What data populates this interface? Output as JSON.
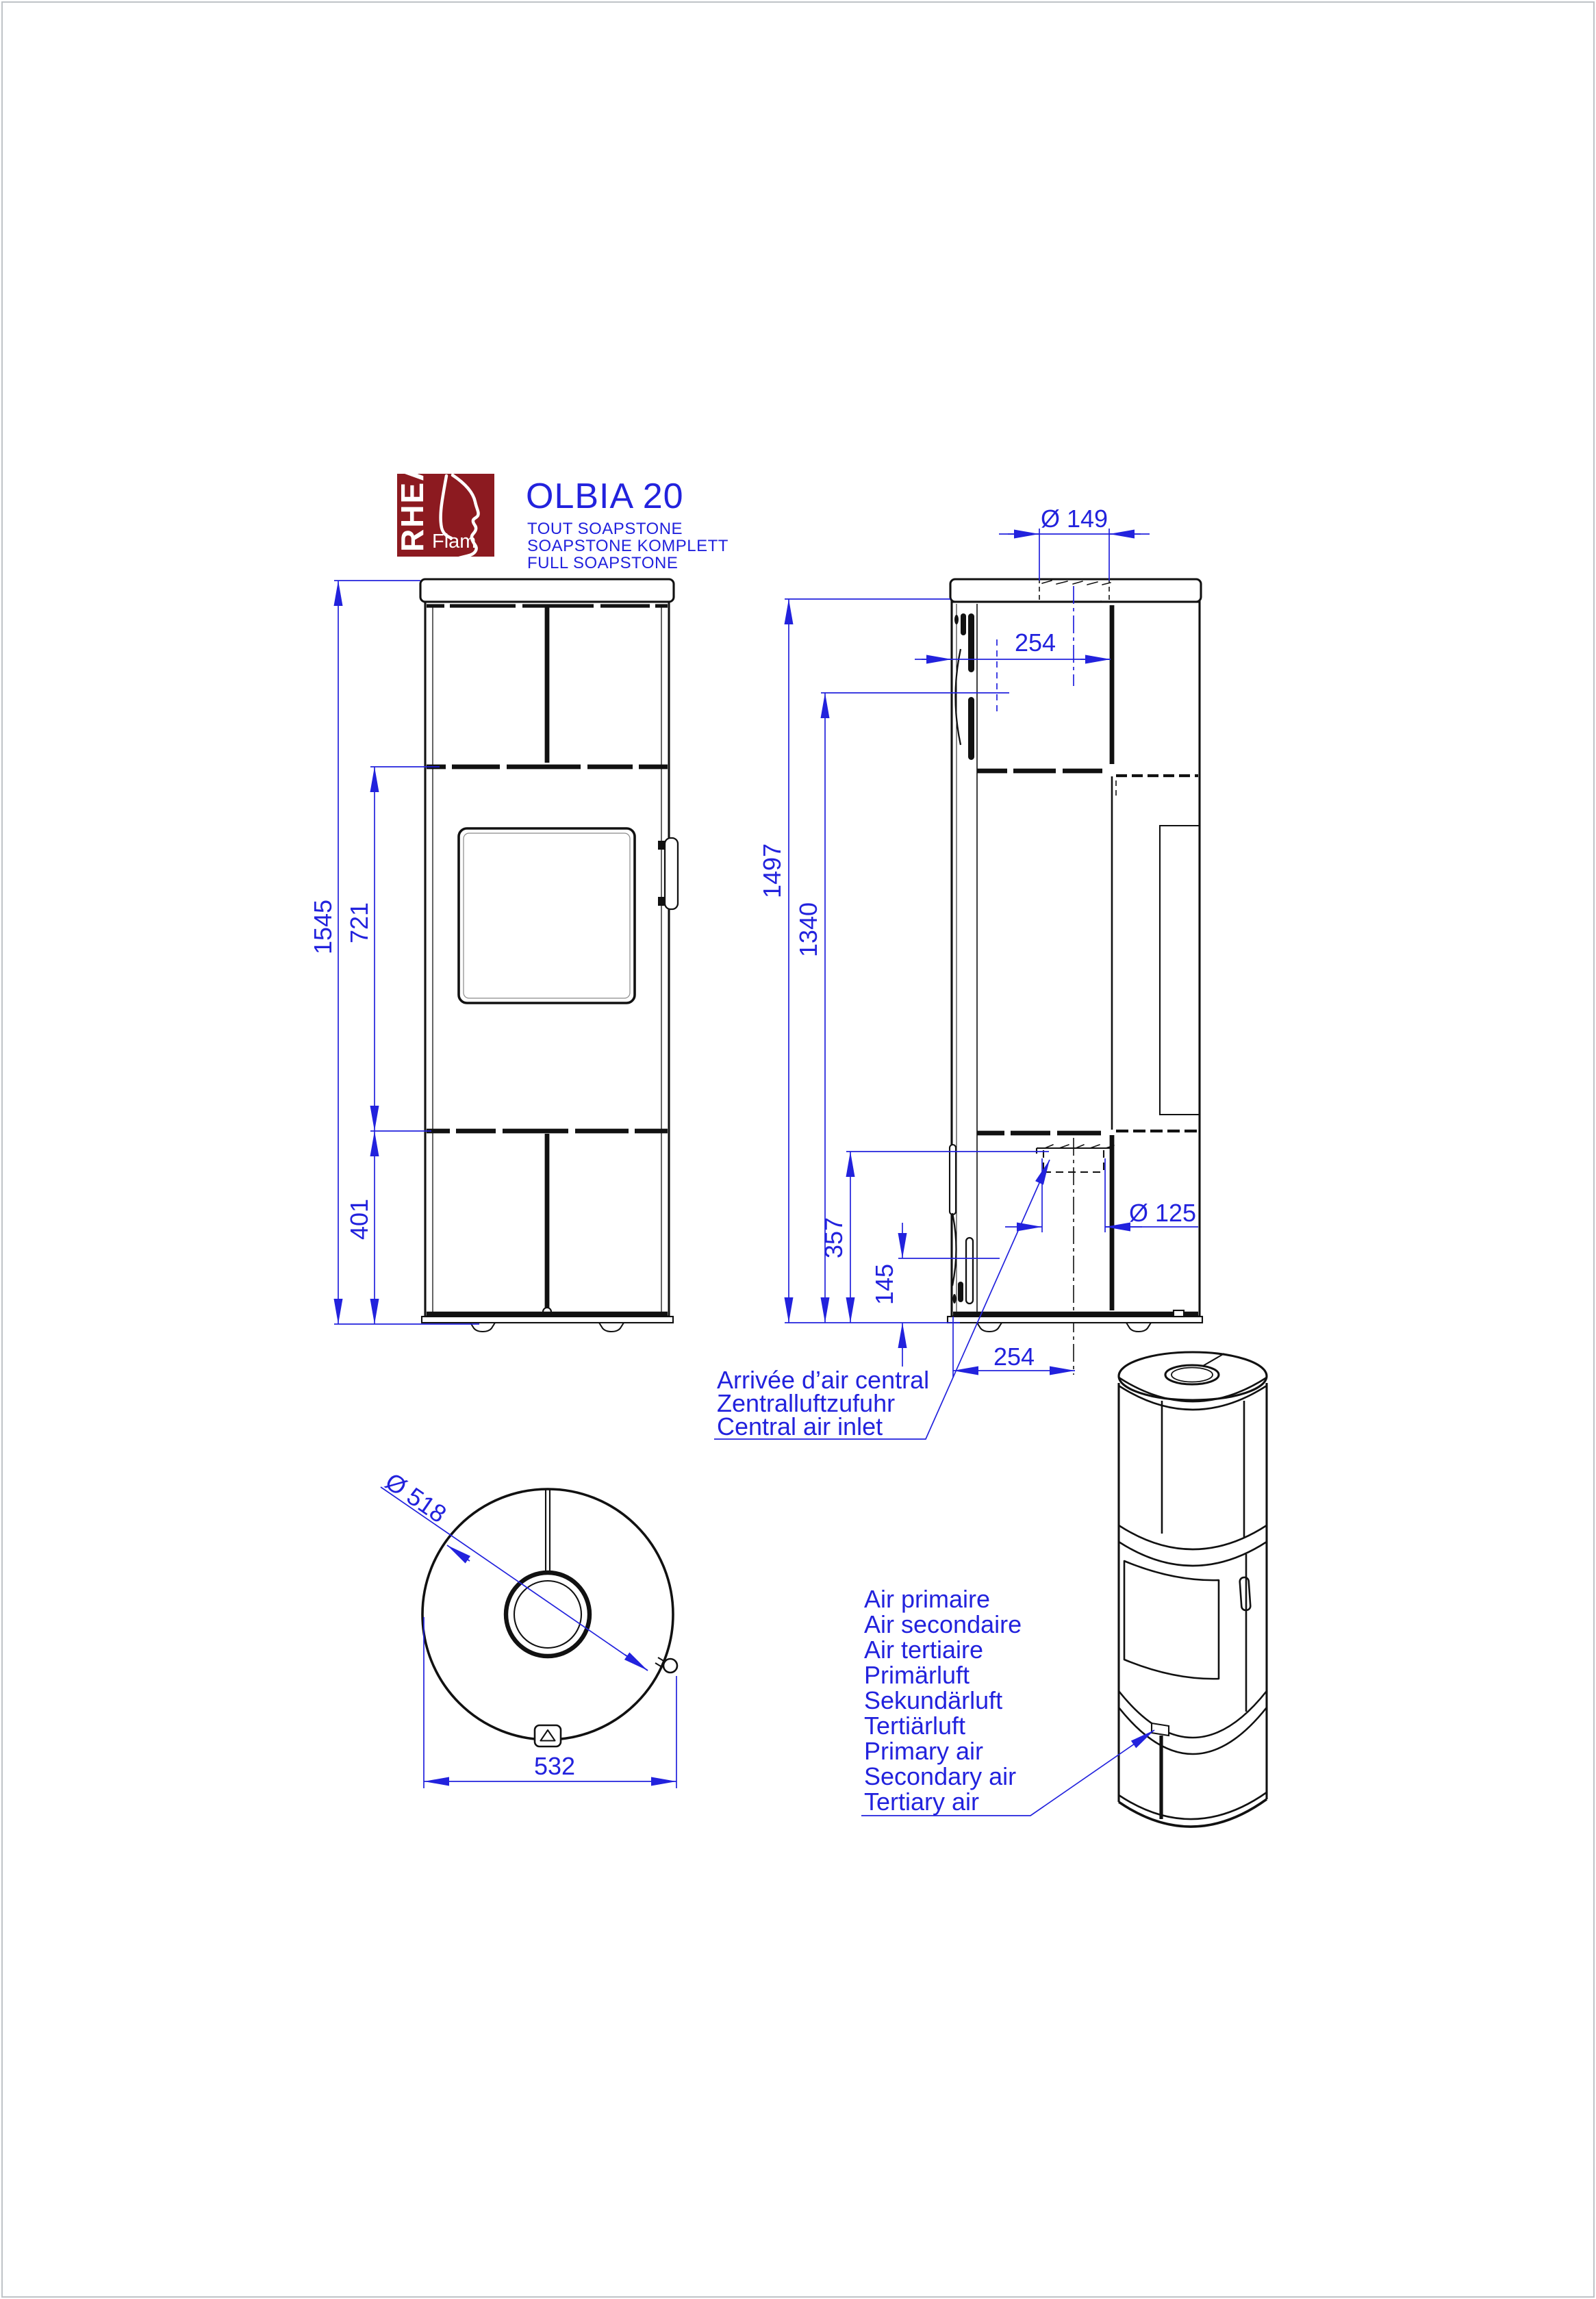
{
  "colors": {
    "line": "#111111",
    "dimension_blue": "#2222dd",
    "logo_red": "#8c1a20",
    "page_border": "#bfc3c7"
  },
  "header": {
    "logo": {
      "brand": "RHEA",
      "brand_sub": "Flam"
    },
    "model": "OLBIA 20",
    "subtitles": [
      "TOUT SOAPSTONE",
      "SOAPSTONE KOMPLETT",
      "FULL SOAPSTONE"
    ]
  },
  "dimensions": {
    "front": {
      "total_height": "1545",
      "mid_height": "721",
      "base_height": "401"
    },
    "side": {
      "flue_diameter": "Ø 149",
      "flue_center_offset": "254",
      "body_height": "1497",
      "vent_height": "1340",
      "inlet_top_height": "357",
      "inlet_height": "145",
      "inlet_center_offset": "254",
      "inlet_diameter": "Ø 125"
    },
    "top": {
      "stone_diameter": "Ø 518",
      "overall_width": "532"
    }
  },
  "labels": {
    "central_air_inlet": [
      "Arrivée d’air central",
      "Zentralluftzufuhr",
      "Central air inlet"
    ],
    "air_supply": [
      "Air primaire",
      "Air secondaire",
      "Air tertiaire",
      "Primärluft",
      "Sekundärluft",
      "Tertiärluft",
      "Primary air",
      "Secondary air",
      "Tertiary air"
    ]
  }
}
